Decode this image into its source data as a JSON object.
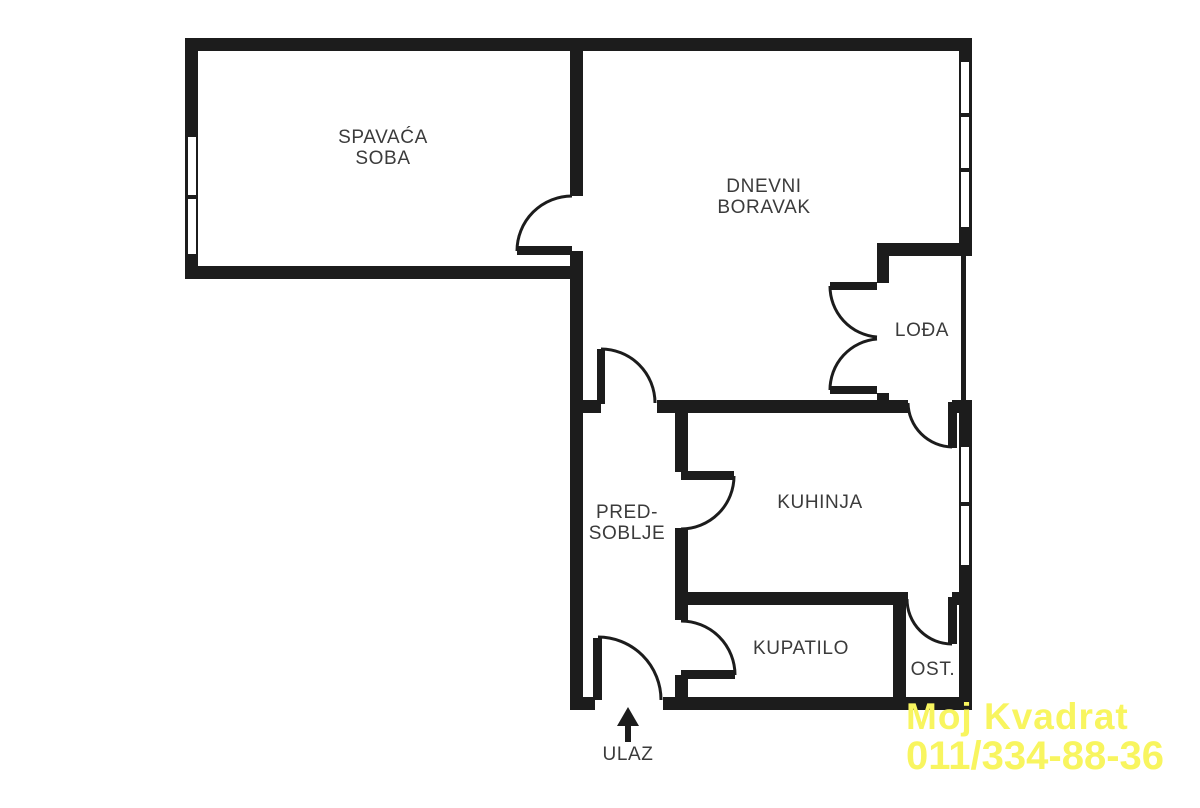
{
  "title": "Apartment floor plan",
  "colors": {
    "wall": "#1c1c1c",
    "label": "#3b3b3b",
    "watermark": "#f8f55f",
    "background": "#ffffff"
  },
  "rooms": [
    {
      "name": "bedroom",
      "lines": [
        "SPAVAĆA",
        "SOBA"
      ]
    },
    {
      "name": "living-room",
      "lines": [
        "DNEVNI",
        "BORAVAK"
      ]
    },
    {
      "name": "loggia",
      "lines": [
        "LOĐA"
      ]
    },
    {
      "name": "hallway",
      "lines": [
        "PRED-",
        "SOBLJE"
      ]
    },
    {
      "name": "kitchen",
      "lines": [
        "KUHINJA"
      ]
    },
    {
      "name": "bathroom",
      "lines": [
        "KUPATILO"
      ]
    },
    {
      "name": "storage",
      "lines": [
        "OST."
      ]
    }
  ],
  "entrance": {
    "label": "ULAZ"
  },
  "watermark": {
    "line1": "Moj Kvadrat",
    "line2": "011/334-88-36"
  }
}
